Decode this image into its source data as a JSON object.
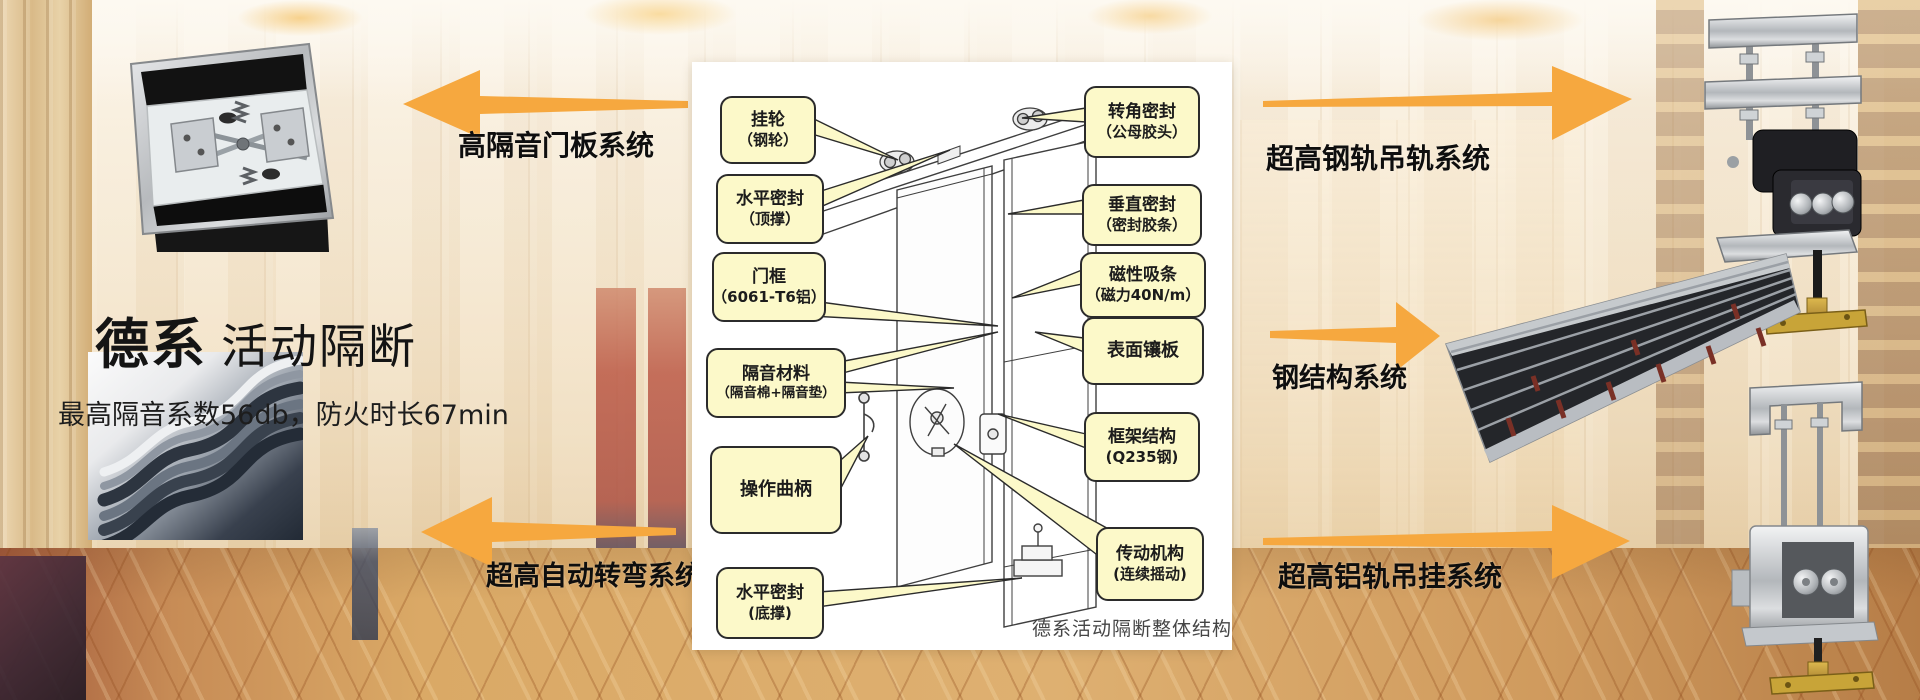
{
  "title": {
    "bold": "德系",
    "rest": "活动隔断"
  },
  "subtitle": "最高隔音系数56db，防火时长67min",
  "systems": {
    "top_left": "高隔音门板系统",
    "bottom_left": "超高自动转弯系统",
    "top_right": "超高钢轨吊轨系统",
    "middle_right": "钢结构系统",
    "bottom_right": "超高铝轨吊挂系统"
  },
  "diagram": {
    "caption": "德系活动隔断整体结构",
    "labels_left": [
      {
        "line1": "挂轮",
        "line2": "（钢轮）"
      },
      {
        "line1": "水平密封",
        "line2": "（顶撑）"
      },
      {
        "line1": "门框",
        "line2": "（6061-T6铝）"
      },
      {
        "line1": "隔音材料",
        "line2": "（隔音棉+隔音垫）"
      },
      {
        "line1": "操作曲柄",
        "line2": ""
      },
      {
        "line1": "水平密封",
        "line2": "(底撑)"
      }
    ],
    "labels_right": [
      {
        "line1": "转角密封",
        "line2": "（公母胶头）"
      },
      {
        "line1": "垂直密封",
        "line2": "（密封胶条）"
      },
      {
        "line1": "磁性吸条",
        "line2": "（磁力40N/m）"
      },
      {
        "line1": "表面镶板",
        "line2": ""
      },
      {
        "line1": "框架结构",
        "line2": "(Q235钢)"
      },
      {
        "line1": "传动机构",
        "line2": "(连续摇动)"
      }
    ]
  },
  "colors": {
    "arrow": "#F6A83F",
    "callout_bg": "#FCF9C9",
    "callout_border": "#2B2B2B",
    "panel_bg": "#FFFFFF"
  }
}
